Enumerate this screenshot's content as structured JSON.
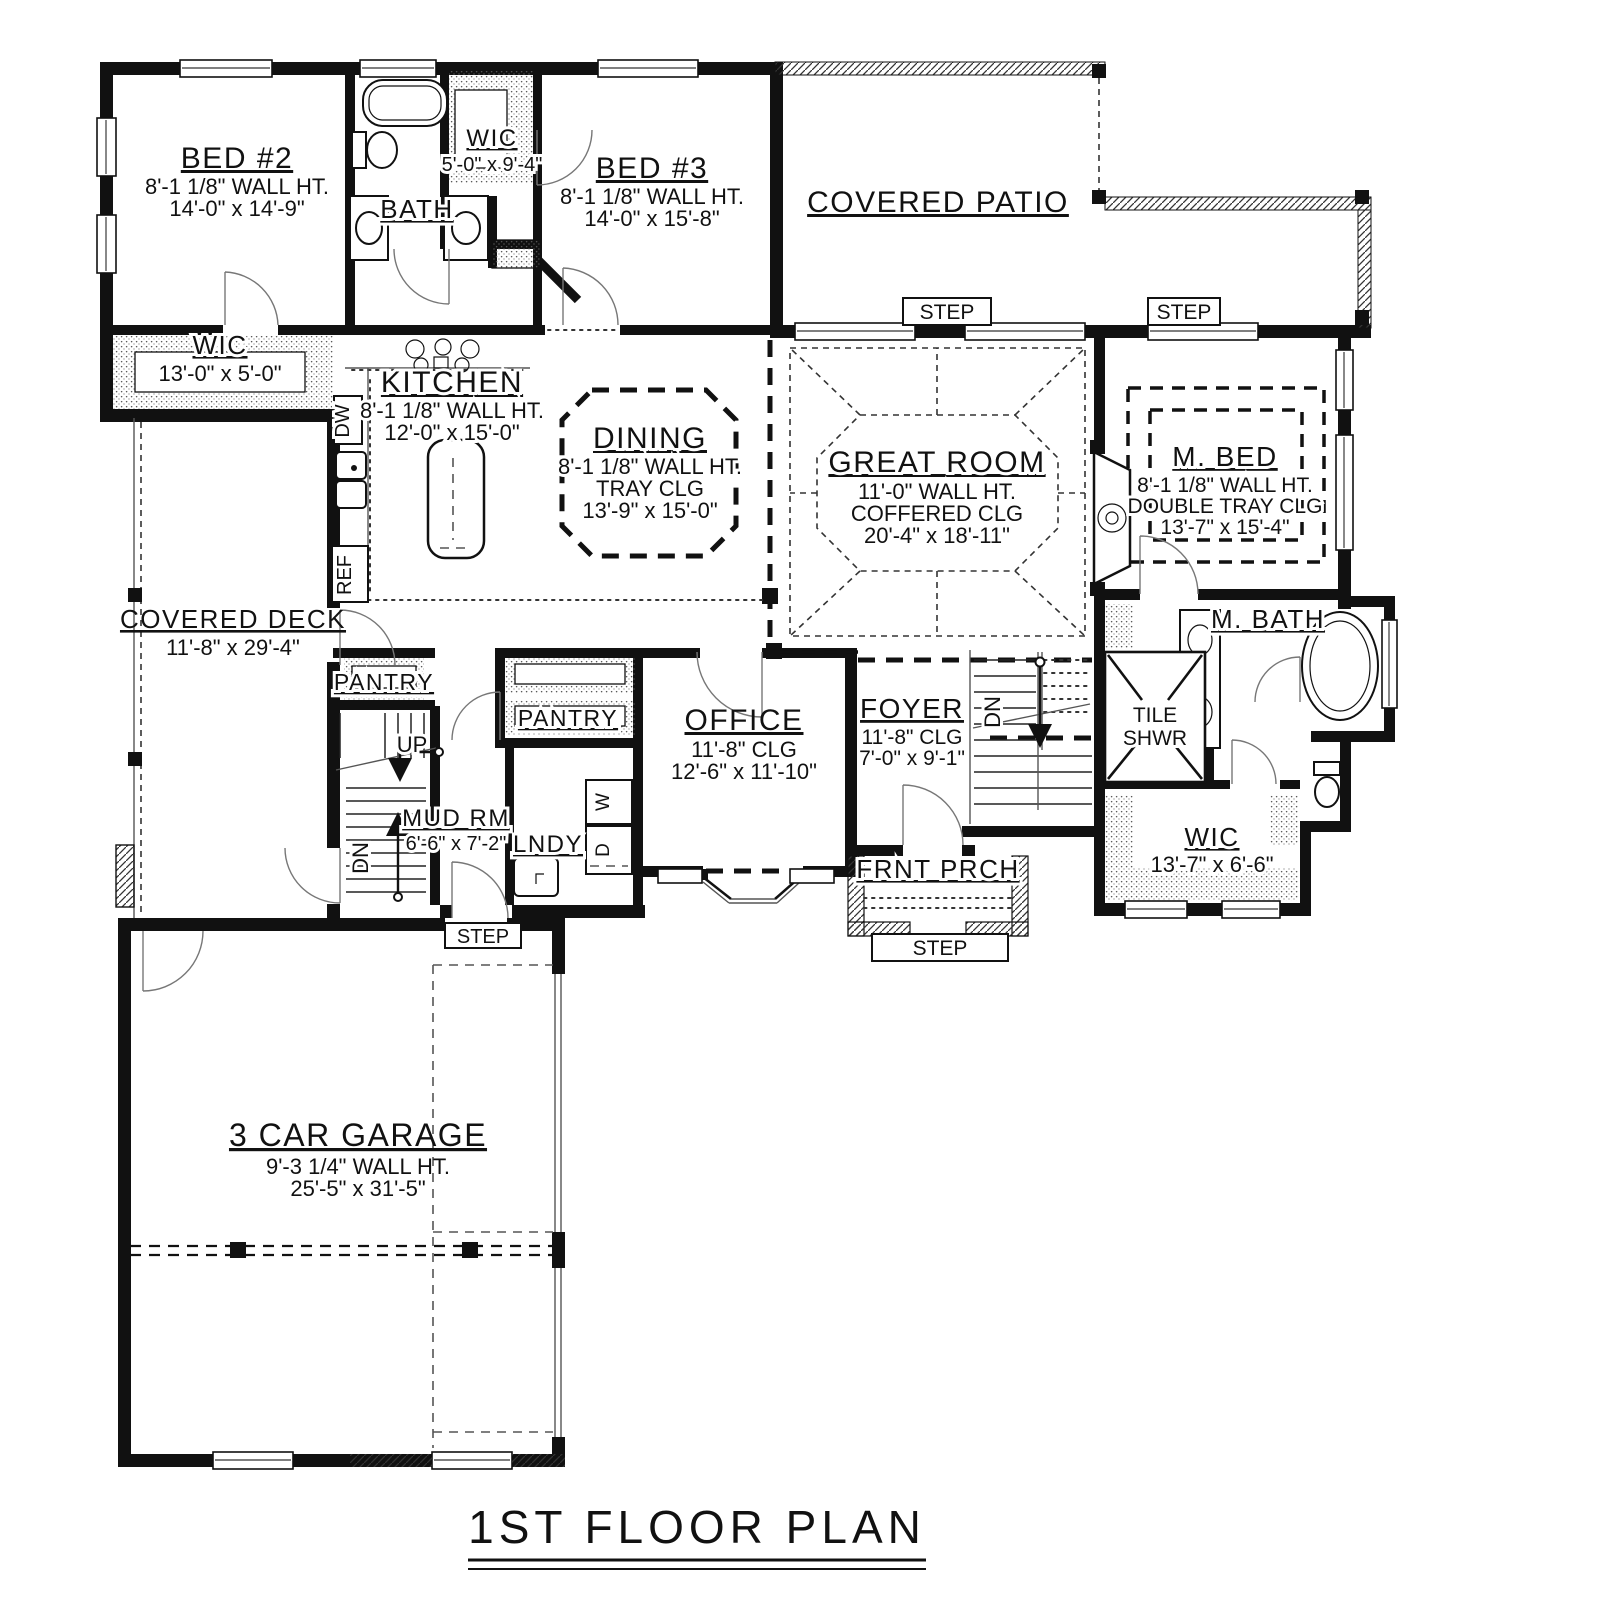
{
  "title": "1ST FLOOR PLAN",
  "rooms": [
    {
      "name": "BED #2",
      "lines": [
        "8'-1 1/8\" WALL HT.",
        "14'-0\" x 14'-9\""
      ]
    },
    {
      "name": "BATH",
      "lines": []
    },
    {
      "name": "WIC",
      "lines": [
        "5'-0\" x 9'-4\""
      ]
    },
    {
      "name": "BED #3",
      "lines": [
        "8'-1 1/8\" WALL HT.",
        "14'-0\" x 15'-8\""
      ]
    },
    {
      "name": "COVERED PATIO",
      "lines": []
    },
    {
      "name": "WIC",
      "lines": [
        "13'-0\" x 5'-0\""
      ]
    },
    {
      "name": "KITCHEN",
      "lines": [
        "8'-1 1/8\" WALL HT.",
        "12'-0\" x 15'-0\""
      ]
    },
    {
      "name": "DINING",
      "lines": [
        "8'-1 1/8\" WALL HT.",
        "TRAY CLG",
        "13'-9\" x 15'-0\""
      ]
    },
    {
      "name": "GREAT ROOM",
      "lines": [
        "11'-0\" WALL HT.",
        "COFFERED CLG",
        "20'-4\" x 18'-11\""
      ]
    },
    {
      "name": "M. BED",
      "lines": [
        "8'-1 1/8\" WALL HT.",
        "DOUBLE TRAY CLG",
        "13'-7\" x 15'-4\""
      ]
    },
    {
      "name": "COVERED DECK",
      "lines": [
        "11'-8\" x 29'-4\""
      ]
    },
    {
      "name": "PANTRY",
      "lines": []
    },
    {
      "name": "PANTRY",
      "lines": []
    },
    {
      "name": "OFFICE",
      "lines": [
        "11'-8\" CLG",
        "12'-6\" x 11'-10\""
      ]
    },
    {
      "name": "FOYER",
      "lines": [
        "11'-8\" CLG",
        "7'-0\" x 9'-1\""
      ]
    },
    {
      "name": "M. BATH",
      "lines": []
    },
    {
      "name": "TILE SHWR",
      "lines": [
        "TILE",
        "SHWR"
      ]
    },
    {
      "name": "MUD RM",
      "lines": [
        "6'-6\" x 7'-2\""
      ]
    },
    {
      "name": "LNDY",
      "lines": []
    },
    {
      "name": "WIC",
      "lines": [
        "13'-7\" x 6'-6\""
      ]
    },
    {
      "name": "FRNT PRCH",
      "lines": []
    },
    {
      "name": "3 CAR GARAGE",
      "lines": [
        "9'-3 1/4\" WALL HT.",
        "25'-5\" x 31'-5\""
      ]
    }
  ],
  "annotations": {
    "step": "STEP",
    "up": "UP",
    "dn": "DN",
    "dw": "DW",
    "ref": "REF",
    "washer": "W",
    "dryer": "D"
  },
  "colors": {
    "wall": "#111111",
    "paper": "#ffffff",
    "thin_line": "#555555"
  }
}
